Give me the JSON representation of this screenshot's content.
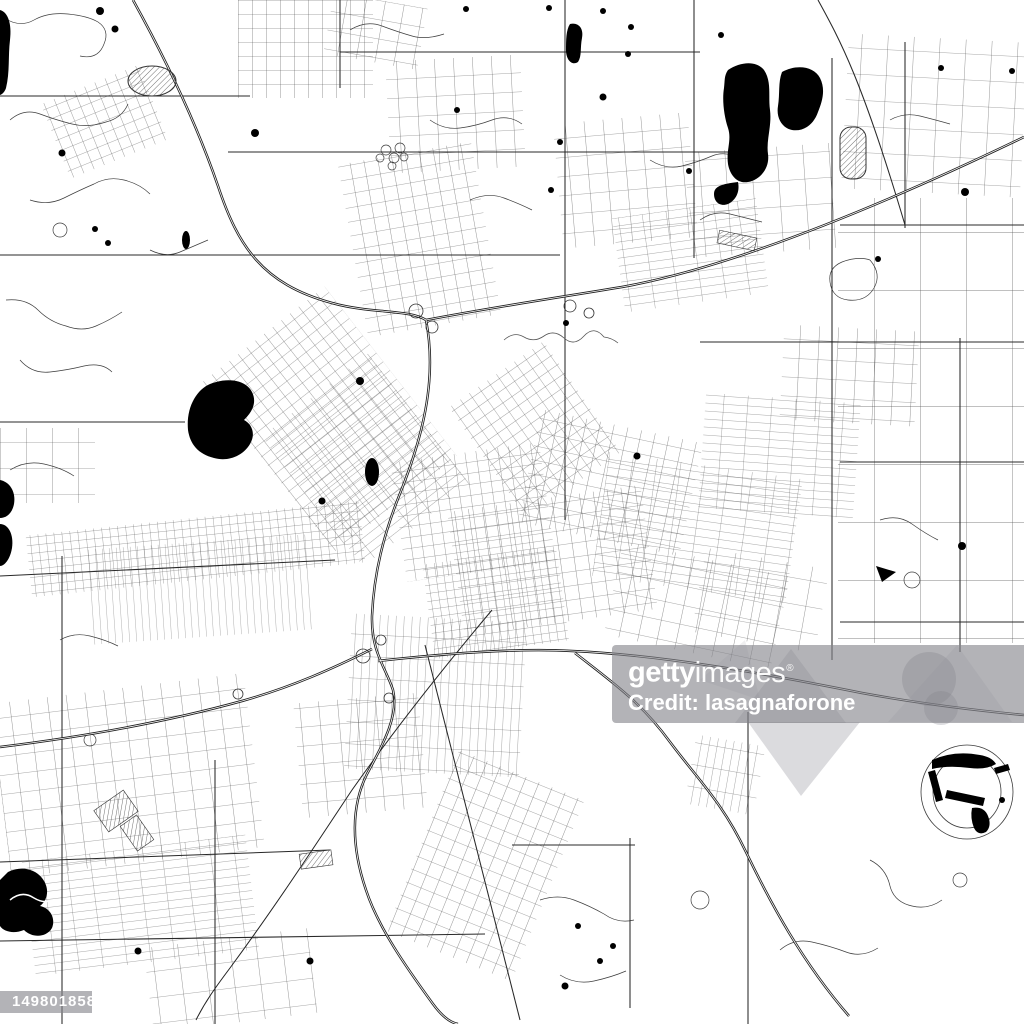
{
  "map": {
    "description": "Black and white vector city street map with highways, street grids and lakes",
    "background_color": "#ffffff",
    "road_color": "#3d3d3d",
    "arterial_color": "#282828",
    "highway_color": "#1d1d1d",
    "water_color": "#000000"
  },
  "watermark": {
    "brand_bold": "getty",
    "brand_light": "images",
    "registered_mark": "®",
    "credit": "Credit: lasagnaforone",
    "image_id": "1498018586",
    "band_color": "#84848a",
    "text_color": "#ffffff"
  }
}
